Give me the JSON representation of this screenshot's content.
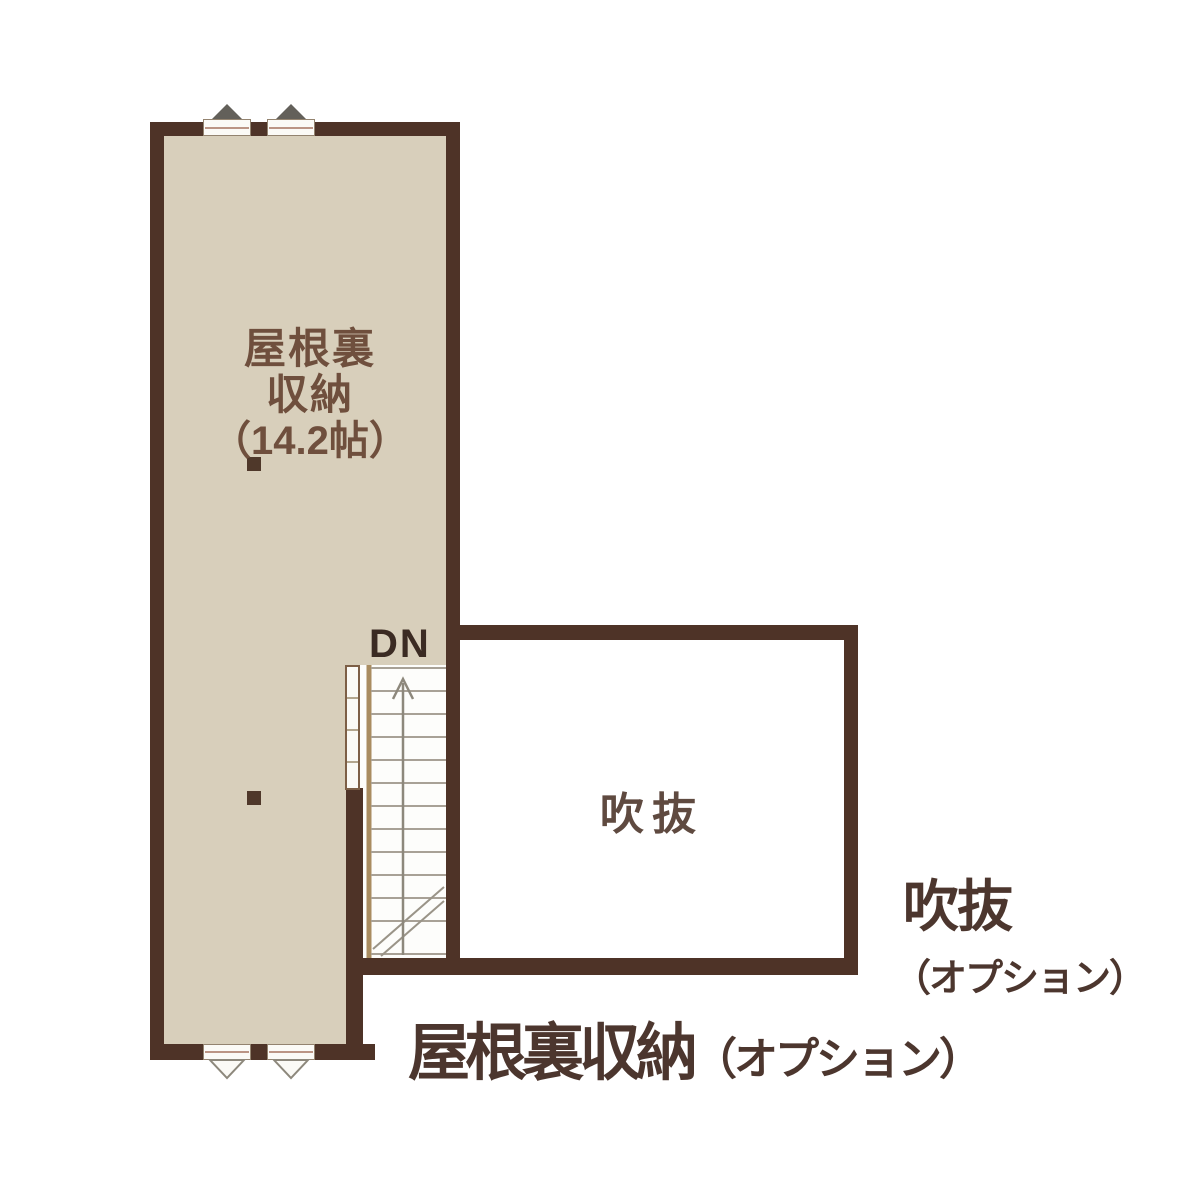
{
  "colors": {
    "wall": "#4e3327",
    "floor": "#d8cfbb",
    "ink": "#4c362e",
    "room-ink": "#6f4f3d"
  },
  "attic_room": {
    "label_line1": "屋根裏",
    "label_line2": "収納",
    "label_size": "（14.2帖）"
  },
  "void_room": {
    "label": "吹抜"
  },
  "stairs": {
    "label": "DN"
  },
  "captions": {
    "void_title": "吹抜",
    "void_option": "（オプション）",
    "attic_title": "屋根裏収納",
    "attic_option": "（オプション）"
  }
}
